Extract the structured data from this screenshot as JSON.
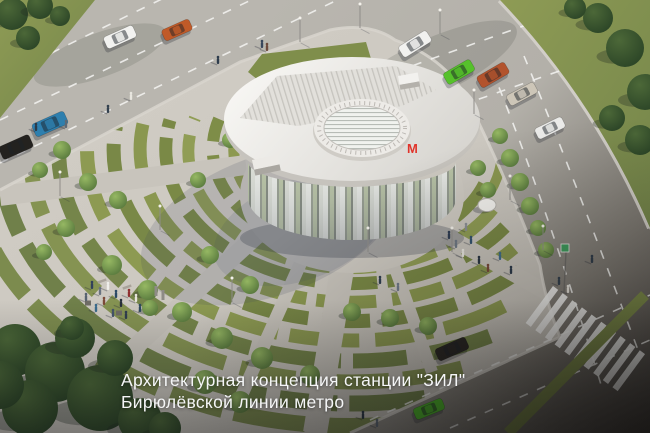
{
  "caption": {
    "line1": "Архитектурная концепция станции \"ЗИЛ\"",
    "line2": "Бирюлёвской линии метро"
  },
  "building": {
    "metro_logo": "М",
    "metro_logo_color": "#e0342b"
  },
  "palette": {
    "plaza": "#ccc8c0",
    "road_light": "#b7b4ad",
    "road_dark": "#4a4642",
    "garden_green": "#849249",
    "tree_dark": "#33502e",
    "tree_light": "#7aa24d",
    "roof_white": "#f2f1ee",
    "crosswalk_white": "#f5f5f3"
  },
  "scene": {
    "cars": [
      {
        "color": "#f2f2f0",
        "x": 120,
        "y": 37,
        "angle": -24,
        "w": 32,
        "h": 13
      },
      {
        "color": "#c05a28",
        "x": 177,
        "y": 30,
        "angle": -24,
        "w": 30,
        "h": 12
      },
      {
        "color": "#2e7fae",
        "x": 50,
        "y": 124,
        "angle": -24,
        "w": 35,
        "h": 14
      },
      {
        "color": "#24221f",
        "x": 16,
        "y": 147,
        "angle": -24,
        "w": 33,
        "h": 14
      },
      {
        "color": "#f1f1ef",
        "x": 415,
        "y": 44,
        "angle": -32,
        "w": 33,
        "h": 13
      },
      {
        "color": "#56c12b",
        "x": 459,
        "y": 72,
        "angle": -30,
        "w": 31,
        "h": 13
      },
      {
        "color": "#b2532d",
        "x": 493,
        "y": 75,
        "angle": -30,
        "w": 32,
        "h": 13
      },
      {
        "color": "#cdc6b8",
        "x": 522,
        "y": 94,
        "angle": -28,
        "w": 31,
        "h": 12
      },
      {
        "color": "#ebebe9",
        "x": 550,
        "y": 128,
        "angle": -26,
        "w": 30,
        "h": 12
      },
      {
        "color": "#2a2724",
        "x": 452,
        "y": 349,
        "angle": -24,
        "w": 33,
        "h": 13
      },
      {
        "color": "#4fbd2a",
        "x": 429,
        "y": 409,
        "angle": -22,
        "w": 31,
        "h": 12
      }
    ],
    "trees": [
      [
        12,
        14,
        16,
        "d"
      ],
      [
        40,
        6,
        13,
        "d"
      ],
      [
        28,
        38,
        12,
        "d"
      ],
      [
        60,
        16,
        10,
        "d"
      ],
      [
        598,
        18,
        15,
        "d"
      ],
      [
        625,
        48,
        19,
        "d"
      ],
      [
        645,
        92,
        18,
        "d"
      ],
      [
        640,
        140,
        15,
        "d"
      ],
      [
        575,
        8,
        11,
        "d"
      ],
      [
        612,
        118,
        13,
        "d"
      ],
      [
        15,
        350,
        26,
        "d"
      ],
      [
        55,
        372,
        30,
        "d"
      ],
      [
        100,
        398,
        33,
        "d"
      ],
      [
        30,
        408,
        28,
        "d"
      ],
      [
        140,
        420,
        22,
        "d"
      ],
      [
        75,
        338,
        20,
        "d"
      ],
      [
        0,
        385,
        24,
        "d"
      ],
      [
        165,
        428,
        16,
        "d"
      ],
      [
        115,
        358,
        18,
        "d"
      ],
      [
        72,
        328,
        12,
        "d"
      ],
      [
        62,
        150,
        9,
        "l"
      ],
      [
        40,
        170,
        8,
        "l"
      ],
      [
        88,
        182,
        9,
        "l"
      ],
      [
        118,
        200,
        9,
        "l"
      ],
      [
        66,
        228,
        9,
        "l"
      ],
      [
        44,
        252,
        8,
        "l"
      ],
      [
        112,
        265,
        10,
        "l"
      ],
      [
        148,
        290,
        10,
        "l"
      ],
      [
        182,
        312,
        10,
        "l"
      ],
      [
        222,
        338,
        11,
        "l"
      ],
      [
        262,
        358,
        11,
        "l"
      ],
      [
        310,
        375,
        10,
        "l"
      ],
      [
        150,
        308,
        8,
        "l"
      ],
      [
        352,
        312,
        9,
        "l"
      ],
      [
        390,
        318,
        9,
        "l"
      ],
      [
        428,
        326,
        9,
        "l"
      ],
      [
        230,
        140,
        8,
        "l"
      ],
      [
        210,
        255,
        9,
        "l"
      ],
      [
        250,
        285,
        9,
        "l"
      ],
      [
        198,
        180,
        8,
        "l"
      ],
      [
        500,
        136,
        8,
        "l"
      ],
      [
        510,
        158,
        9,
        "l"
      ],
      [
        520,
        182,
        9,
        "l"
      ],
      [
        530,
        206,
        9,
        "l"
      ],
      [
        538,
        228,
        8,
        "l"
      ],
      [
        546,
        250,
        8,
        "l"
      ],
      [
        478,
        168,
        8,
        "l"
      ],
      [
        488,
        190,
        8,
        "l"
      ],
      [
        205,
        382,
        12,
        "l"
      ],
      [
        240,
        402,
        11,
        "l"
      ]
    ],
    "people": [
      [
        92,
        288,
        "#31405a"
      ],
      [
        100,
        294,
        "#6b7480"
      ],
      [
        108,
        289,
        "#efeeea"
      ],
      [
        116,
        297,
        "#2c4a66"
      ],
      [
        104,
        304,
        "#7c4a38"
      ],
      [
        96,
        311,
        "#3a6b8c"
      ],
      [
        121,
        306,
        "#262f3a"
      ],
      [
        129,
        296,
        "#8e3030"
      ],
      [
        136,
        301,
        "#e8e5dd"
      ],
      [
        113,
        316,
        "#44546b"
      ],
      [
        126,
        318,
        "#2f3c4e"
      ],
      [
        86,
        300,
        "#566270"
      ],
      [
        140,
        311,
        "#2e4a5e"
      ],
      [
        449,
        238,
        "#2f3d52"
      ],
      [
        456,
        247,
        "#6e7884"
      ],
      [
        463,
        256,
        "#e9e7e0"
      ],
      [
        471,
        243,
        "#33536f"
      ],
      [
        479,
        263,
        "#2a3644"
      ],
      [
        488,
        271,
        "#7a4a3a"
      ],
      [
        500,
        259,
        "#3f6d8e"
      ],
      [
        511,
        273,
        "#2c3a4a"
      ],
      [
        466,
        230,
        "#8b8f96"
      ],
      [
        262,
        47,
        "#37465c"
      ],
      [
        267,
        50,
        "#6d4a3c"
      ],
      [
        218,
        63,
        "#2e3c4c"
      ],
      [
        131,
        99,
        "#e8e6df"
      ],
      [
        108,
        112,
        "#33414f"
      ],
      [
        36,
        130,
        "#2c3a48"
      ],
      [
        66,
        127,
        "#5d6875"
      ],
      [
        380,
        283,
        "#2f3e50"
      ],
      [
        398,
        290,
        "#70798a"
      ],
      [
        559,
        284,
        "#33404e"
      ],
      [
        568,
        292,
        "#e9e6de"
      ],
      [
        363,
        418,
        "#2b3947"
      ],
      [
        377,
        426,
        "#5f6a78"
      ],
      [
        592,
        262,
        "#2f3c4a"
      ]
    ],
    "lights": [
      [
        300,
        42
      ],
      [
        360,
        28
      ],
      [
        440,
        34
      ],
      [
        474,
        114
      ],
      [
        510,
        200
      ],
      [
        368,
        252
      ],
      [
        452,
        252
      ],
      [
        160,
        230
      ],
      [
        60,
        196
      ],
      [
        232,
        302
      ],
      [
        543,
        250
      ]
    ],
    "objects": [
      {
        "t": "totem",
        "x": 156,
        "y": 296
      },
      {
        "t": "totem",
        "x": 163,
        "y": 300
      },
      {
        "t": "planter",
        "x": 88,
        "y": 303
      },
      {
        "t": "planter",
        "x": 119,
        "y": 313
      },
      {
        "t": "bench",
        "x": 102,
        "y": 281
      },
      {
        "t": "bench",
        "x": 127,
        "y": 287
      },
      {
        "t": "disc",
        "x": 487,
        "y": 205
      }
    ]
  }
}
